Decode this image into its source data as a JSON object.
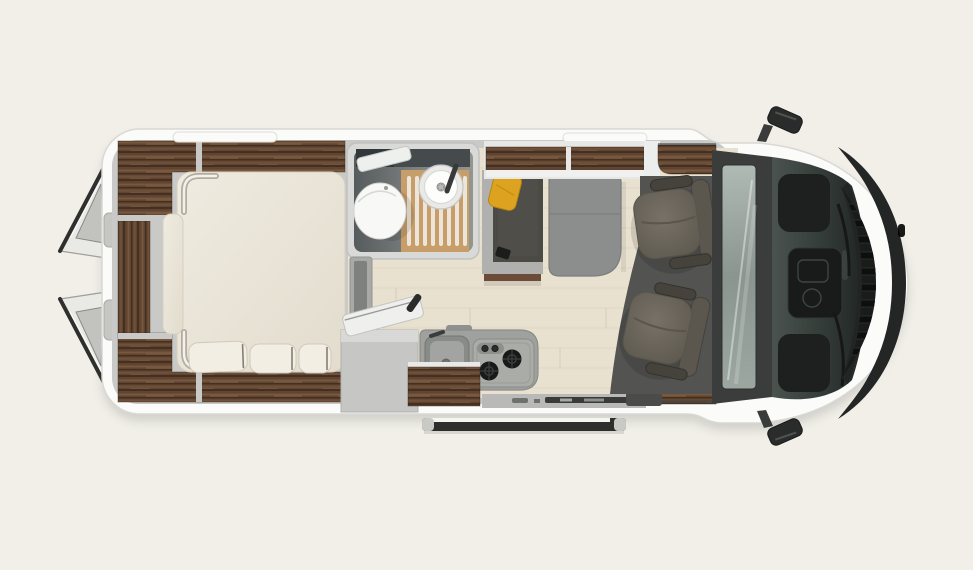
{
  "scene": {
    "type": "floorplan-top-view",
    "subject": "camper van motorhome layout, top-down cutaway",
    "background_color": "#f1efe8"
  },
  "palette": {
    "body_shell": "#fbfbfa",
    "inner_trim": "#c9cac7",
    "wood_dark": "#5e4431",
    "wood_light_slats": "#c79e6a",
    "floor": "#e9e1d0",
    "mattress": "#eae5d9",
    "pillow": "#f2eee4",
    "bench_dark": "#4c4a45",
    "accent_cushion_yellow": "#dda320",
    "table_gray": "#8b8e8c",
    "seat_fabric": "#6c675f",
    "windshield_glass": "#3f4846",
    "grille_black": "#1a1c1b"
  },
  "regions": {
    "rear_windows": "two open pop-out rear windows",
    "rear_bed": "rear double bed with three pillows",
    "cabinets": "dark wood wardrobes and overhead cabinets",
    "bathroom": "wet bath with toilet, slatted shower floor and round basin",
    "kitchen": "kitchenette with sink, two-burner hob and top-opening fridge",
    "dinette": "side bench with yellow cushion and gray table",
    "cab_seats": "two swivelled cab captain seats",
    "front_end": "cab front with windshield, dashboard, mirrors and grille",
    "entry_door": "sliding entry door threshold with exterior rail"
  },
  "counts": {
    "pillows": 3,
    "hob_burners": 2,
    "cab_seats": 2,
    "mirrors": 2,
    "rear_windows": 2
  }
}
